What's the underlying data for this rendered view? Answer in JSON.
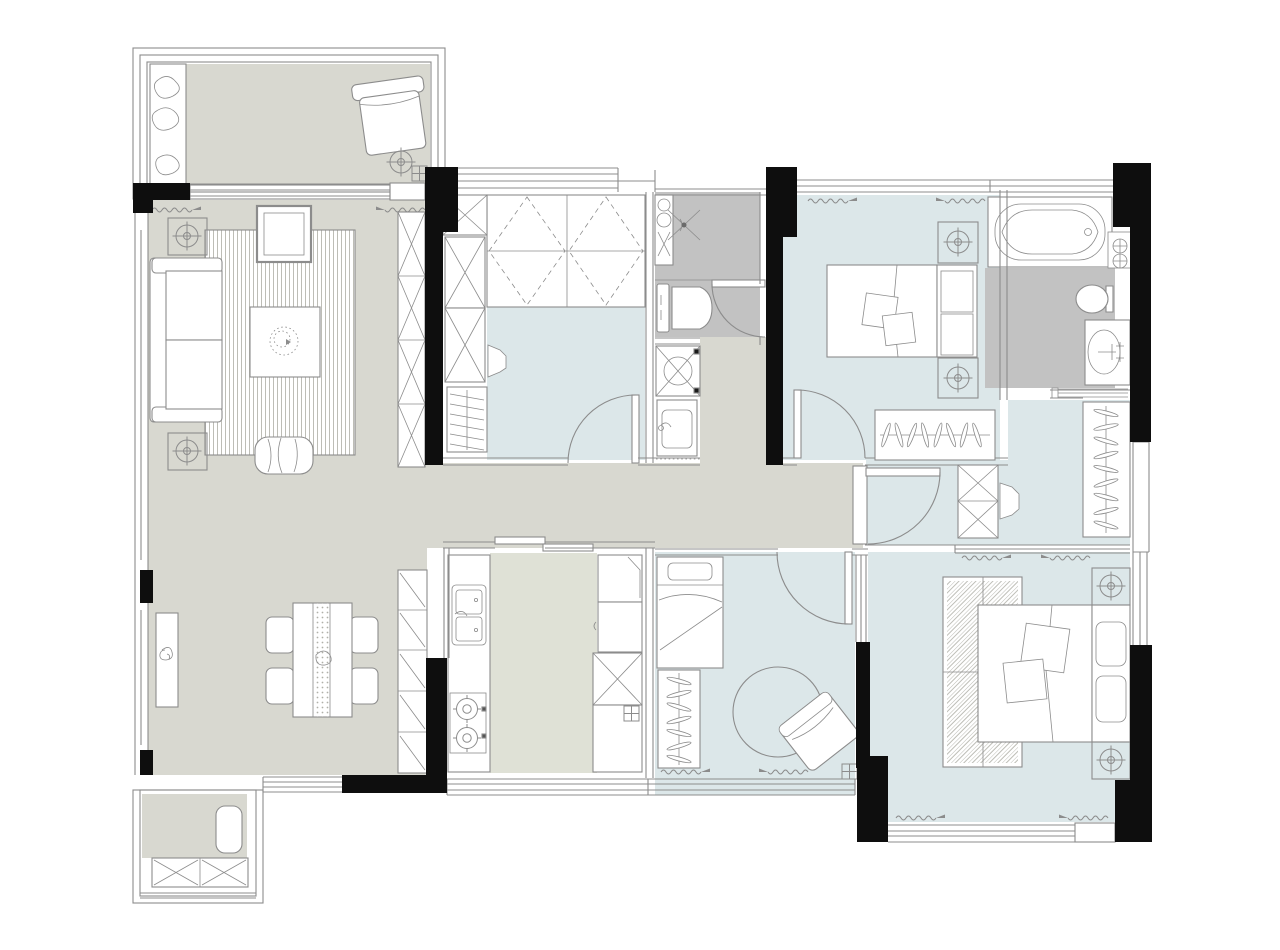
{
  "diagram": {
    "type": "floor-plan",
    "description": "Top-down architectural floor plan of a three/four-room apartment, no text labels",
    "rooms": [
      {
        "id": "balcony-top",
        "label": "top balcony",
        "floor": "public",
        "furniture": [
          "planter-with-plants",
          "armchair",
          "floor-drain",
          "drain-grid"
        ]
      },
      {
        "id": "living-room",
        "label": "living room",
        "floor": "public",
        "furniture": [
          "sofa",
          "side-table-plant",
          "side-table-plant",
          "striped-area-rug",
          "coffee-table-with-plant",
          "tv-cabinet",
          "bench-pouf",
          "tall-display-cabinet"
        ]
      },
      {
        "id": "dining-area",
        "label": "dining area",
        "floor": "public",
        "furniture": [
          "sideboard",
          "dining-table-with-runner",
          "chair",
          "chair",
          "chair",
          "chair",
          "slatted-storage-cabinet"
        ]
      },
      {
        "id": "tatami-bedroom",
        "label": "tatami bedroom / study",
        "floor": "bedroom",
        "furniture": [
          "tatami-platform-bed",
          "wardrobe-x-cells",
          "slanted-shoe-rack",
          "desk-chair",
          "swing-door"
        ]
      },
      {
        "id": "shared-bathroom",
        "label": "shared bathroom + laundry",
        "floor": "bathroom",
        "furniture": [
          "washbasin-counter",
          "shower-drain",
          "toilet",
          "swing-door",
          "washing-machine",
          "laundry-sink"
        ]
      },
      {
        "id": "bedroom-2",
        "label": "bedroom (top right)",
        "floor": "bedroom",
        "furniture": [
          "double-bed",
          "nightstand-plant",
          "nightstand-plant",
          "built-in-hanger-closet",
          "swing-door"
        ]
      },
      {
        "id": "ensuite-bathroom",
        "label": "en-suite bathroom",
        "floor": "bathroom",
        "furniture": [
          "bathtub",
          "shower-controls",
          "toilet",
          "vanity-oval-sink",
          "towel-rail"
        ]
      },
      {
        "id": "dressing-room",
        "label": "dressing room",
        "floor": "bedroom",
        "furniture": [
          "hanger-rack-vertical",
          "cabinet-x-cells",
          "desk-chair",
          "swing-door"
        ]
      },
      {
        "id": "kitchen",
        "label": "kitchen",
        "floor": "kitchen",
        "furniture": [
          "double-sink",
          "two-burner-cooktop",
          "fridge",
          "wall-cabinet",
          "cabinet-x-cell",
          "base-cabinet",
          "sliding-door"
        ]
      },
      {
        "id": "bedroom-3",
        "label": "bedroom (bottom center)",
        "floor": "bedroom",
        "furniture": [
          "single-bed",
          "hanger-rack",
          "round-rug",
          "rotated-armchair",
          "swing-door",
          "drain-grid"
        ]
      },
      {
        "id": "master-bedroom",
        "label": "master bedroom",
        "floor": "bedroom",
        "furniture": [
          "double-bed",
          "nightstand-plant",
          "nightstand-plant",
          "hatched-rug"
        ]
      },
      {
        "id": "balcony-bottom",
        "label": "service balcony",
        "floor": "public",
        "furniture": [
          "mat",
          "storage-cabinet-x"
        ]
      }
    ]
  },
  "colors": {
    "background": "#ffffff",
    "wall": "#0e0e0e",
    "line": "#8c8c8c",
    "line_light": "#b6b6ae",
    "floor_public": "#d8d8d0",
    "floor_bedroom": "#dce7e9",
    "floor_bathroom": "#c2c2c2",
    "floor_kitchen": "#dfe1d6"
  }
}
